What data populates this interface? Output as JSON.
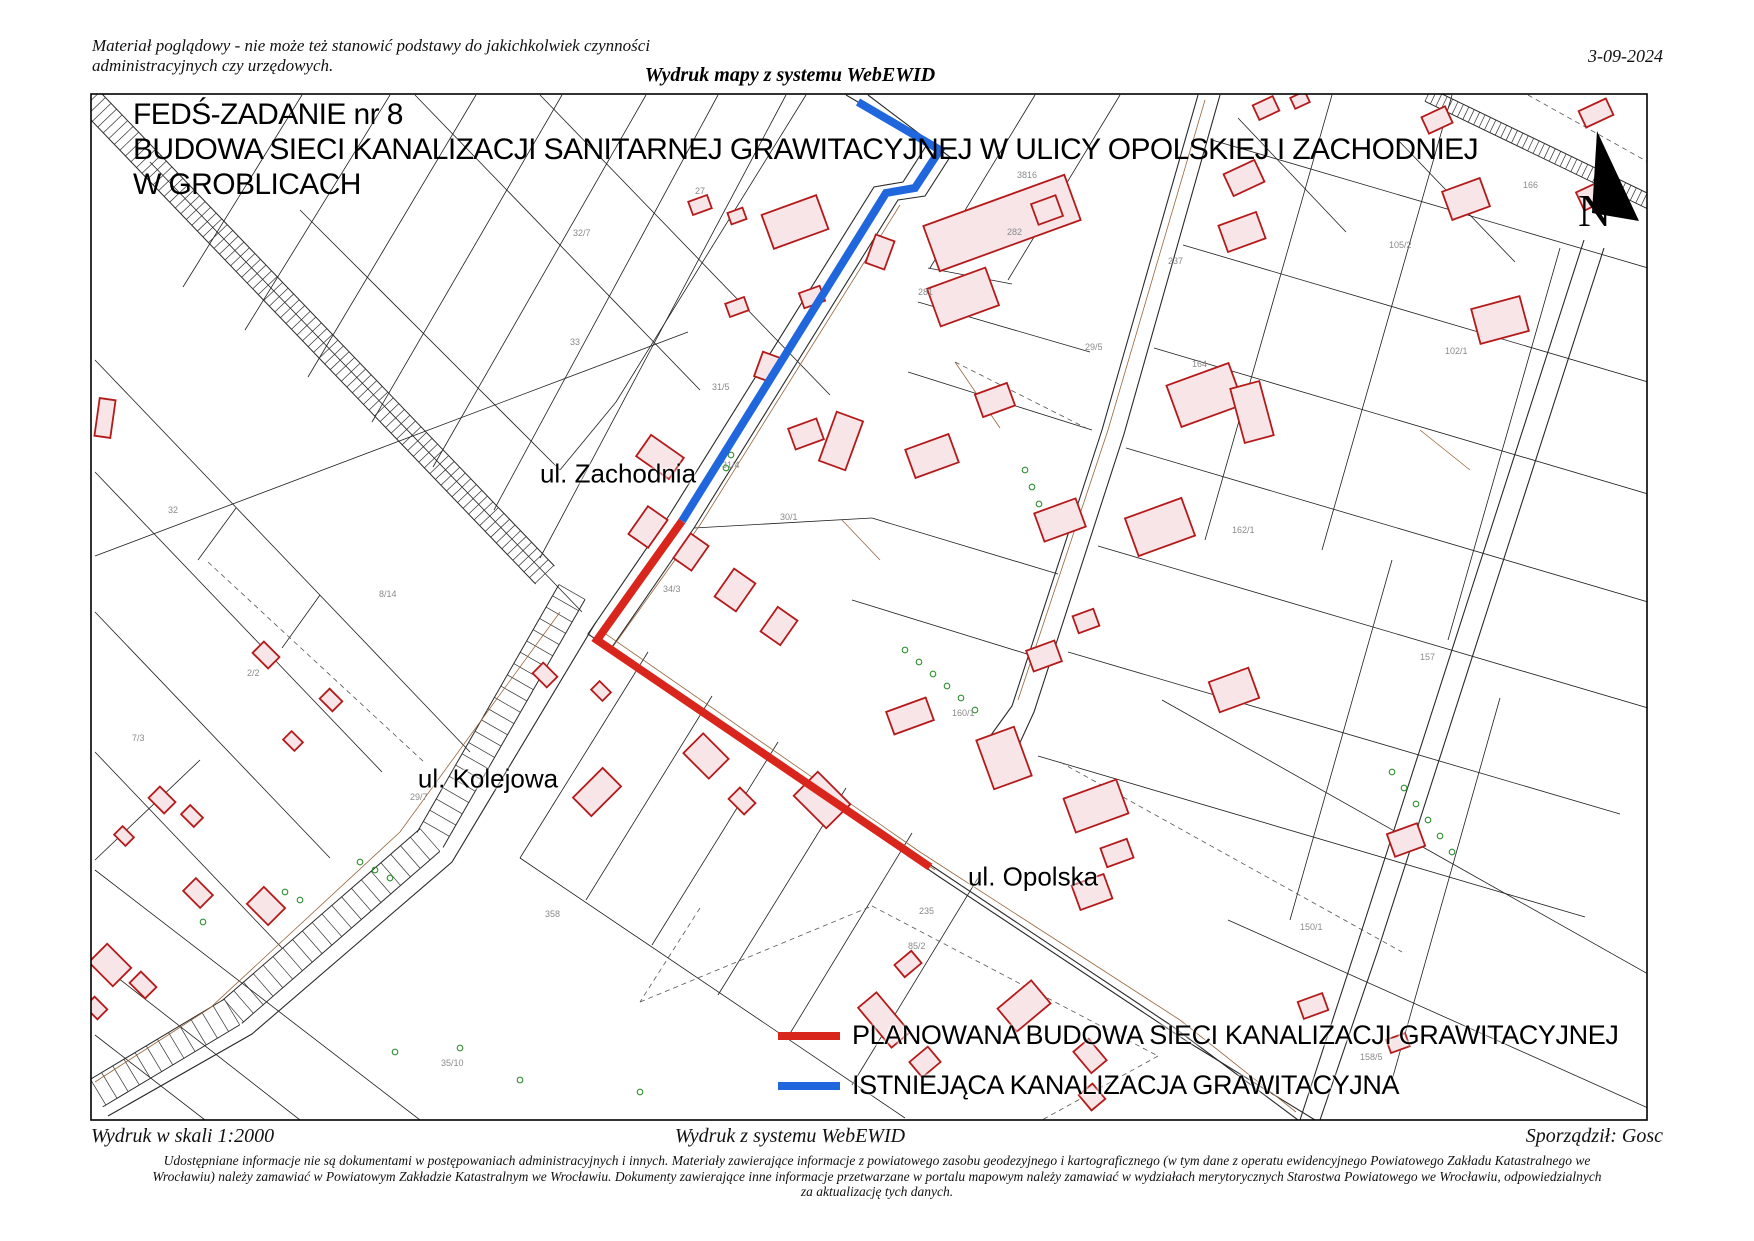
{
  "page": {
    "header": {
      "disclaimer_line1": "Materiał poglądowy - nie może też stanowić podstawy do jakichkolwiek czynności",
      "disclaimer_line2": "administracyjnych czy urzędowych.",
      "date": "3-09-2024",
      "watermark": "Wydruk mapy z systemu WebEWID"
    },
    "title": {
      "line1": "FEDŚ-ZADANIE nr 8",
      "line2": "BUDOWA SIECI KANALIZACJI SANITARNEJ GRAWITACYJNEJ W ULICY OPOLSKIEJ I ZACHODNIEJ",
      "line3": "W GROBLICACH"
    },
    "street_labels": [
      {
        "text": "ul. Zachodnia",
        "x": 618,
        "y": 474
      },
      {
        "text": "ul. Kolejowa",
        "x": 488,
        "y": 779
      },
      {
        "text": "ul. Opolska",
        "x": 1033,
        "y": 877
      }
    ],
    "legend": [
      {
        "label": "PLANOWANA BUDOWA SIECI KANALIZACJI GRAWITACYJNEJ",
        "color": "#d9261c",
        "bar_x": 778,
        "bar_y": 1032,
        "text_x": 850,
        "text_y": 1038
      },
      {
        "label": "ISTNIEJĄCA KANALIZACJA GRAWITACYJNA",
        "color": "#2066dd",
        "bar_x": 778,
        "bar_y": 1085,
        "text_x": 850,
        "text_y": 1088
      }
    ],
    "footer": {
      "scale": "Wydruk w skali 1:2000",
      "system": "Wydruk z systemu WebEWID",
      "author": "Sporządził: Gosc",
      "disclaimer": "Udostępniane informacje nie są dokumentami w postępowaniach administracyjnych i innych. Materiały zawierające informacje z powiatowego zasobu geodezyjnego i kartograficznego (w tym dane z operatu ewidencyjnego Powiatowego Zakładu Katastralnego we Wrocławiu) należy zamawiać w Powiatowym Zakładzie Katastralnym we Wrocławiu. Dokumenty zawierające inne informacje przetwarzane w portalu mapowym należy zamawiać w wydziałach merytorycznych Starostwa Powiatowego we Wrocławiu, odpowiedzialnych za aktualizację tych danych."
    }
  },
  "map": {
    "frame": {
      "x": 91,
      "y": 94,
      "w": 1556,
      "h": 1026
    },
    "colors": {
      "parcel": "#1f1f1f",
      "road": "#2a2a2a",
      "dashed": "#555555",
      "building_fill": "#f7e5e8",
      "building_stroke": "#b51a1a",
      "tree": "#2f8f2f",
      "utility": "#96663c",
      "label": "#8a8a8a",
      "planned": "#d9261c",
      "existing": "#2066dd"
    },
    "planned_line": {
      "points": [
        [
          682,
          521
        ],
        [
          597,
          640
        ],
        [
          930,
          867
        ]
      ]
    },
    "existing_line": {
      "points": [
        [
          858,
          102
        ],
        [
          940,
          150
        ],
        [
          915,
          188
        ],
        [
          886,
          193
        ],
        [
          682,
          521
        ]
      ]
    },
    "compass": {
      "poly": [
        [
          1597,
          131
        ],
        [
          1592,
          213
        ],
        [
          1639,
          221
        ]
      ],
      "label": "N",
      "x": 1578,
      "y": 226
    },
    "railways": [
      {
        "pts": [
          [
            85,
            95
          ],
          [
            545,
            575
          ]
        ],
        "w": 26,
        "step": 8
      },
      {
        "pts": [
          [
            1428,
            95
          ],
          [
            1660,
            207
          ]
        ],
        "w": 14,
        "step": 6
      },
      {
        "pts": [
          [
            572,
            592
          ],
          [
            430,
            840
          ],
          [
            232,
            1012
          ],
          [
            95,
            1094
          ]
        ],
        "w": 30,
        "step": 13
      }
    ],
    "road_polylines": [
      [
        [
          846,
          95
        ],
        [
          928,
          143
        ],
        [
          903,
          182
        ],
        [
          874,
          187
        ],
        [
          670,
          514
        ],
        [
          588,
          634
        ],
        [
          920,
          858
        ],
        [
          1172,
          1026
        ],
        [
          1298,
          1120
        ]
      ],
      [
        [
          868,
          95
        ],
        [
          950,
          157
        ],
        [
          925,
          196
        ],
        [
          898,
          200
        ],
        [
          694,
          528
        ],
        [
          610,
          650
        ],
        [
          938,
          876
        ],
        [
          1188,
          1042
        ],
        [
          1315,
          1120
        ]
      ],
      [
        [
          1198,
          95
        ],
        [
          1102,
          430
        ],
        [
          1012,
          706
        ],
        [
          986,
          742
        ]
      ],
      [
        [
          1220,
          95
        ],
        [
          1124,
          434
        ],
        [
          1034,
          712
        ],
        [
          1012,
          760
        ]
      ],
      [
        [
          1584,
          240
        ],
        [
          1468,
          600
        ],
        [
          1358,
          942
        ],
        [
          1300,
          1120
        ]
      ],
      [
        [
          1604,
          248
        ],
        [
          1488,
          608
        ],
        [
          1378,
          950
        ],
        [
          1320,
          1120
        ]
      ],
      [
        [
          596,
          622
        ],
        [
          452,
          862
        ],
        [
          252,
          1034
        ],
        [
          108,
          1116
        ]
      ]
    ],
    "parcel_lines": [
      [
        302,
        95,
        183,
        287
      ],
      [
        390,
        95,
        245,
        330
      ],
      [
        476,
        95,
        308,
        377
      ],
      [
        562,
        95,
        372,
        422
      ],
      [
        646,
        95,
        433,
        467
      ],
      [
        718,
        95,
        494,
        510
      ],
      [
        786,
        95,
        540,
        558
      ],
      [
        150,
        162,
        582,
        612
      ],
      [
        95,
        360,
        470,
        752
      ],
      [
        95,
        472,
        382,
        772
      ],
      [
        95,
        612,
        330,
        858
      ],
      [
        95,
        752,
        282,
        948
      ],
      [
        236,
        508,
        198,
        560
      ],
      [
        320,
        595,
        282,
        648
      ],
      [
        95,
        556,
        688,
        332
      ],
      [
        806,
        95,
        616,
        402
      ],
      [
        616,
        402,
        560,
        470
      ],
      [
        415,
        95,
        700,
        390
      ],
      [
        540,
        95,
        830,
        395
      ],
      [
        300,
        210,
        560,
        470
      ],
      [
        1035,
        95,
        930,
        268
      ],
      [
        1120,
        95,
        1008,
        280
      ],
      [
        928,
        268,
        1012,
        284
      ],
      [
        918,
        302,
        1090,
        352
      ],
      [
        908,
        372,
        1092,
        430
      ],
      [
        872,
        518,
        1058,
        574
      ],
      [
        852,
        600,
        1040,
        658
      ],
      [
        694,
        528,
        872,
        518
      ],
      [
        1212,
        140,
        1648,
        268
      ],
      [
        1183,
        245,
        1648,
        382
      ],
      [
        1154,
        348,
        1648,
        494
      ],
      [
        1126,
        448,
        1648,
        602
      ],
      [
        1098,
        546,
        1648,
        708
      ],
      [
        1068,
        652,
        1620,
        814
      ],
      [
        1038,
        756,
        1585,
        917
      ],
      [
        1332,
        95,
        1205,
        540
      ],
      [
        1452,
        95,
        1322,
        550
      ],
      [
        1560,
        248,
        1448,
        640
      ],
      [
        1392,
        560,
        1290,
        920
      ],
      [
        1500,
        698,
        1392,
        1080
      ],
      [
        1162,
        700,
        1648,
        974
      ],
      [
        1228,
        920,
        1648,
        1108
      ],
      [
        648,
        652,
        520,
        858
      ],
      [
        712,
        696,
        586,
        900
      ],
      [
        778,
        742,
        652,
        945
      ],
      [
        846,
        788,
        718,
        995
      ],
      [
        912,
        833,
        786,
        1040
      ],
      [
        978,
        878,
        852,
        1085
      ],
      [
        520,
        858,
        905,
        1118
      ],
      [
        95,
        870,
        420,
        1120
      ],
      [
        95,
        960,
        300,
        1120
      ],
      [
        95,
        1035,
        205,
        1120
      ],
      [
        200,
        760,
        95,
        860
      ],
      [
        1238,
        118,
        1346,
        232
      ],
      [
        1398,
        140,
        1515,
        262
      ]
    ],
    "dashed_lines": [
      [
        640,
        1002,
        872,
        906
      ],
      [
        872,
        906,
        1158,
        1056
      ],
      [
        1158,
        1056,
        1042,
        1120
      ],
      [
        700,
        908,
        640,
        1002
      ],
      [
        1060,
        762,
        1402,
        952
      ],
      [
        1528,
        95,
        1648,
        162
      ],
      [
        208,
        562,
        424,
        762
      ],
      [
        955,
        362,
        1090,
        430
      ]
    ],
    "utility_lines": [
      [
        [
          900,
          205
        ],
        [
          700,
          525
        ],
        [
          612,
          648
        ],
        [
          935,
          870
        ]
      ],
      [
        [
          560,
          612
        ],
        [
          400,
          832
        ],
        [
          210,
          1008
        ],
        [
          95,
          1082
        ]
      ],
      [
        [
          600,
          630
        ],
        [
          920,
          852
        ],
        [
          1180,
          1020
        ],
        [
          1296,
          1112
        ]
      ],
      [
        [
          1205,
          100
        ],
        [
          1108,
          430
        ],
        [
          1018,
          700
        ]
      ],
      [
        [
          955,
          362
        ],
        [
          1000,
          428
        ]
      ],
      [
        [
          842,
          520
        ],
        [
          880,
          560
        ]
      ],
      [
        [
          1420,
          430
        ],
        [
          1470,
          470
        ]
      ]
    ],
    "buildings": [
      [
        700,
        205,
        20,
        14,
        -20
      ],
      [
        737,
        216,
        16,
        12,
        -20
      ],
      [
        795,
        222,
        58,
        36,
        -20
      ],
      [
        1002,
        223,
        150,
        48,
        -20
      ],
      [
        963,
        297,
        62,
        40,
        -20
      ],
      [
        1047,
        210,
        26,
        22,
        -20
      ],
      [
        880,
        252,
        30,
        20,
        -70
      ],
      [
        812,
        297,
        22,
        16,
        -20
      ],
      [
        737,
        307,
        20,
        14,
        -20
      ],
      [
        767,
        367,
        26,
        18,
        -70
      ],
      [
        806,
        434,
        30,
        22,
        -20
      ],
      [
        841,
        441,
        52,
        28,
        -70
      ],
      [
        932,
        456,
        46,
        30,
        -20
      ],
      [
        995,
        400,
        34,
        24,
        -20
      ],
      [
        1060,
        520,
        44,
        30,
        -20
      ],
      [
        1044,
        656,
        30,
        22,
        -20
      ],
      [
        1086,
        621,
        22,
        18,
        -20
      ],
      [
        910,
        716,
        42,
        24,
        -20
      ],
      [
        1004,
        758,
        40,
        52,
        -20
      ],
      [
        1096,
        806,
        56,
        36,
        -20
      ],
      [
        1117,
        853,
        28,
        20,
        -20
      ],
      [
        1092,
        892,
        34,
        26,
        -20
      ],
      [
        660,
        457,
        26,
        40,
        -55
      ],
      [
        648,
        527,
        34,
        24,
        -55
      ],
      [
        691,
        552,
        30,
        22,
        -55
      ],
      [
        735,
        590,
        34,
        26,
        -55
      ],
      [
        779,
        626,
        30,
        24,
        -55
      ],
      [
        1205,
        395,
        66,
        44,
        -20
      ],
      [
        1252,
        412,
        30,
        56,
        -15
      ],
      [
        1160,
        527,
        60,
        40,
        -20
      ],
      [
        1234,
        690,
        42,
        32,
        -20
      ],
      [
        1242,
        232,
        40,
        28,
        -20
      ],
      [
        1244,
        178,
        34,
        24,
        -25
      ],
      [
        1266,
        108,
        22,
        16,
        -25
      ],
      [
        1300,
        100,
        16,
        12,
        -25
      ],
      [
        1437,
        120,
        26,
        18,
        -25
      ],
      [
        1406,
        840,
        32,
        24,
        -20
      ],
      [
        1596,
        113,
        30,
        18,
        -25
      ],
      [
        1592,
        196,
        26,
        20,
        -25
      ],
      [
        1466,
        199,
        40,
        30,
        -20
      ],
      [
        1500,
        320,
        50,
        36,
        -15
      ],
      [
        266,
        655,
        22,
        16,
        45
      ],
      [
        331,
        700,
        18,
        14,
        45
      ],
      [
        293,
        741,
        16,
        12,
        45
      ],
      [
        162,
        800,
        22,
        16,
        45
      ],
      [
        192,
        816,
        18,
        13,
        45
      ],
      [
        124,
        836,
        16,
        12,
        45
      ],
      [
        266,
        906,
        30,
        24,
        45
      ],
      [
        198,
        893,
        24,
        18,
        45
      ],
      [
        110,
        965,
        34,
        26,
        45
      ],
      [
        143,
        985,
        22,
        16,
        45
      ],
      [
        96,
        1008,
        18,
        14,
        45
      ],
      [
        545,
        675,
        20,
        15,
        45
      ],
      [
        601,
        691,
        16,
        12,
        45
      ],
      [
        597,
        792,
        26,
        42,
        45
      ],
      [
        706,
        756,
        36,
        28,
        45
      ],
      [
        742,
        801,
        22,
        16,
        45
      ],
      [
        822,
        800,
        46,
        34,
        45
      ],
      [
        105,
        418,
        16,
        38,
        8
      ],
      [
        884,
        1020,
        24,
        52,
        -40
      ],
      [
        925,
        1062,
        24,
        20,
        -40
      ],
      [
        1024,
        1006,
        44,
        30,
        -40
      ],
      [
        1090,
        1056,
        20,
        28,
        -40
      ],
      [
        1092,
        1097,
        18,
        20,
        -40
      ],
      [
        908,
        964,
        22,
        16,
        -40
      ],
      [
        1313,
        1006,
        26,
        18,
        -20
      ],
      [
        1398,
        1043,
        20,
        14,
        -20
      ]
    ],
    "trees": [
      [
        905,
        650
      ],
      [
        919,
        662
      ],
      [
        933,
        674
      ],
      [
        947,
        686
      ],
      [
        961,
        698
      ],
      [
        975,
        710
      ],
      [
        1392,
        772
      ],
      [
        1404,
        788
      ],
      [
        1416,
        804
      ],
      [
        1428,
        820
      ],
      [
        1440,
        836
      ],
      [
        1452,
        852
      ],
      [
        1025,
        470
      ],
      [
        1032,
        487
      ],
      [
        1039,
        504
      ],
      [
        285,
        892
      ],
      [
        300,
        900
      ],
      [
        360,
        862
      ],
      [
        375,
        870
      ],
      [
        390,
        878
      ],
      [
        460,
        1048
      ],
      [
        520,
        1080
      ],
      [
        395,
        1052
      ],
      [
        640,
        1092
      ],
      [
        731,
        455
      ],
      [
        726,
        468
      ],
      [
        203,
        922
      ]
    ],
    "parcel_labels": [
      [
        695,
        194,
        "27"
      ],
      [
        1017,
        178,
        "3816"
      ],
      [
        1007,
        235,
        "282"
      ],
      [
        918,
        295,
        "281"
      ],
      [
        1085,
        350,
        "29/5"
      ],
      [
        1168,
        264,
        "237"
      ],
      [
        545,
        917,
        "358"
      ],
      [
        441,
        1066,
        "35/10"
      ],
      [
        908,
        949,
        "85/2"
      ],
      [
        919,
        914,
        "235"
      ],
      [
        168,
        513,
        "32"
      ],
      [
        663,
        592,
        "34/3"
      ],
      [
        712,
        390,
        "31/5"
      ],
      [
        722,
        468,
        "31/4"
      ],
      [
        1445,
        354,
        "102/1"
      ],
      [
        1389,
        248,
        "105/2"
      ],
      [
        1523,
        188,
        "166"
      ],
      [
        1192,
        367,
        "164"
      ],
      [
        1232,
        533,
        "162/1"
      ],
      [
        952,
        716,
        "160/1"
      ],
      [
        1420,
        660,
        "157"
      ],
      [
        1300,
        930,
        "150/1"
      ],
      [
        379,
        597,
        "8/14"
      ],
      [
        247,
        676,
        "2/2"
      ],
      [
        132,
        741,
        "7/3"
      ],
      [
        573,
        236,
        "32/7"
      ],
      [
        410,
        800,
        "29/7"
      ],
      [
        1360,
        1060,
        "158/5"
      ],
      [
        570,
        345,
        "33"
      ],
      [
        780,
        520,
        "30/1"
      ]
    ]
  }
}
